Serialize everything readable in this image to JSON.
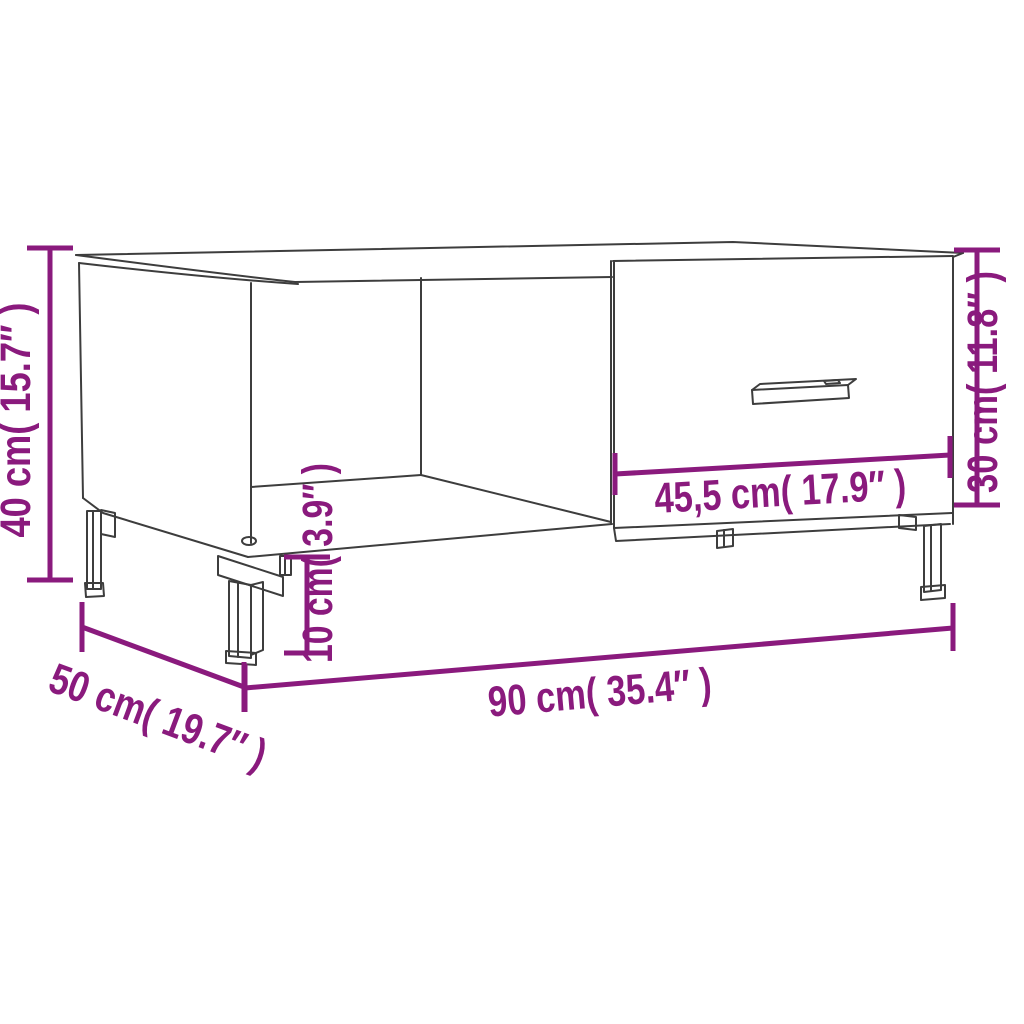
{
  "diagram": {
    "kind": "product-dimension-diagram",
    "background": "#FFFFFF"
  },
  "colors": {
    "dimension_accent": "#8A1A7D",
    "outline": "#3D3D3D"
  },
  "dims": {
    "overall_height": {
      "label": "40 cm( 15.7″ )"
    },
    "right_section_height": {
      "label": "30 cm( 11.8″ )"
    },
    "ground_clearance": {
      "label": "10 cm( 3.9″ )"
    },
    "drawer_width": {
      "label": "45,5 cm( 17.9″ )"
    },
    "overall_width": {
      "label": "90 cm( 35.4″ )"
    },
    "overall_depth": {
      "label": "50 cm( 19.7″ )"
    }
  }
}
